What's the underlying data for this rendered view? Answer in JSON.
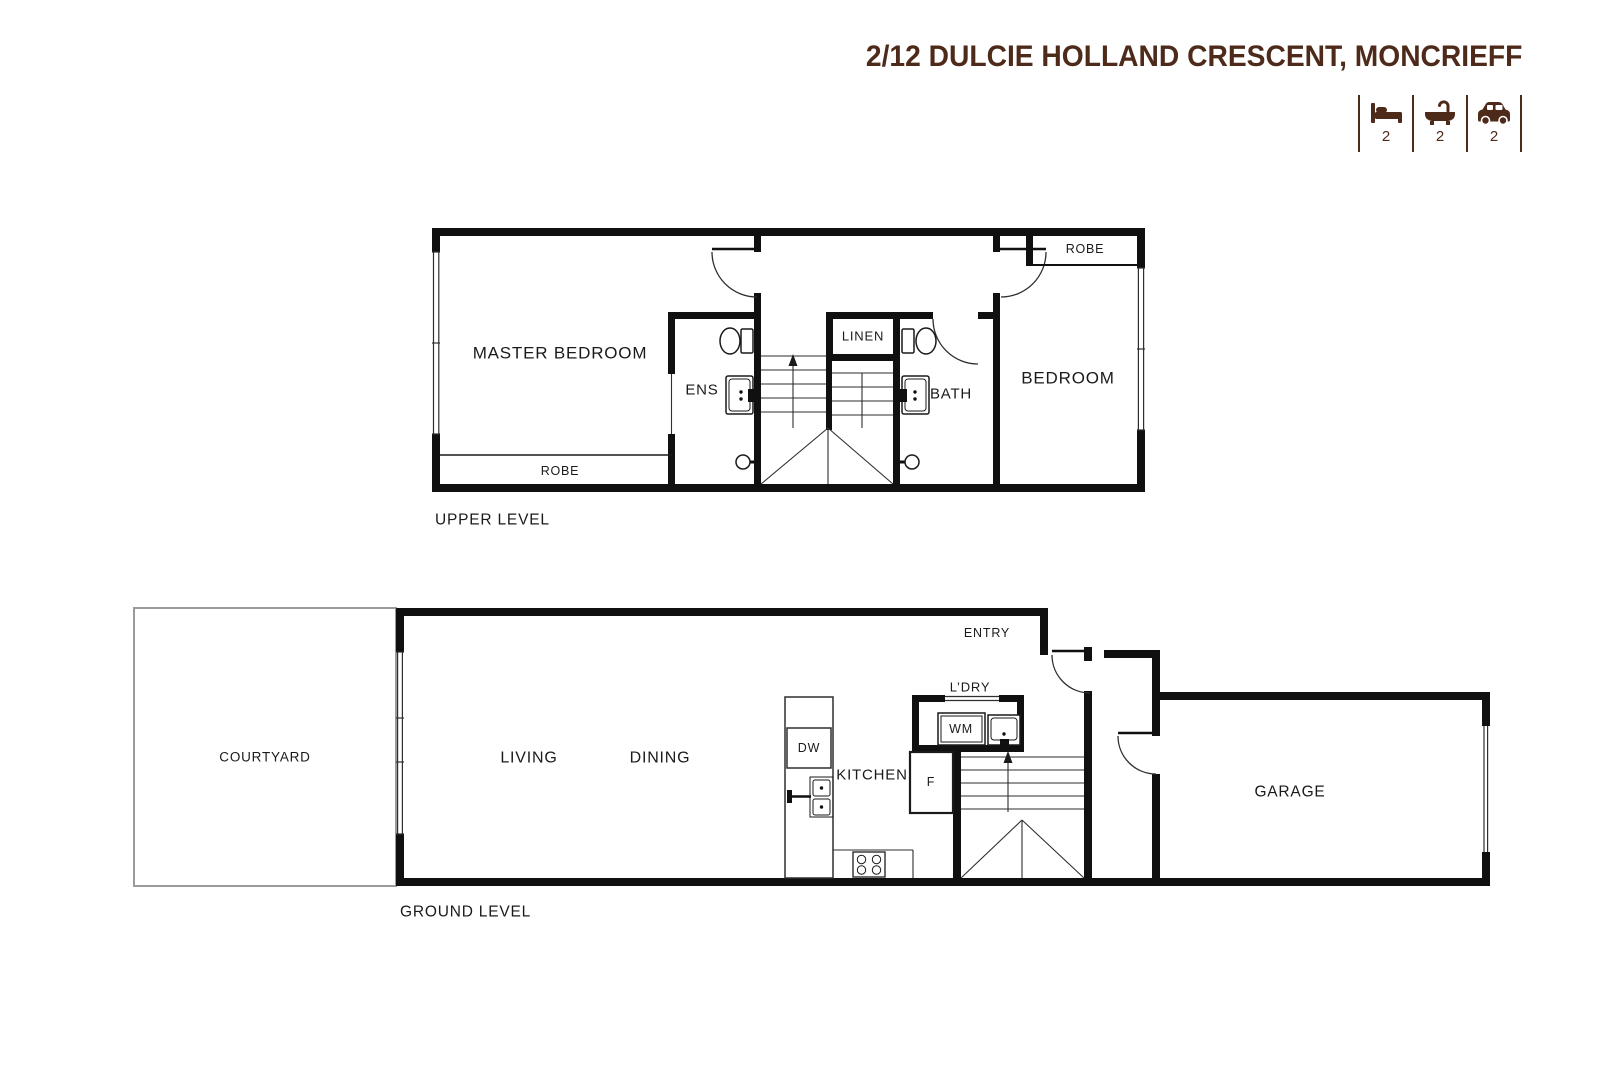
{
  "title": "2/12 DULCIE HOLLAND CRESCENT, MONCRIEFF",
  "colors": {
    "accent_brown": "#4e2a1a",
    "wall_black": "#101010",
    "courtyard_border": "#9b9b9b",
    "background": "#ffffff"
  },
  "stats": {
    "bedrooms": {
      "icon": "bed-icon",
      "value": "2"
    },
    "bathrooms": {
      "icon": "bath-icon",
      "value": "2"
    },
    "cars": {
      "icon": "car-icon",
      "value": "2"
    }
  },
  "upper_level": {
    "label": "UPPER LEVEL",
    "rooms": {
      "master_bedroom": "MASTER BEDROOM",
      "robe_master": "ROBE",
      "ens": "ENS",
      "linen": "LINEN",
      "bath": "BATH",
      "bedroom": "BEDROOM",
      "robe_bedroom": "ROBE"
    }
  },
  "ground_level": {
    "label": "GROUND LEVEL",
    "rooms": {
      "courtyard": "COURTYARD",
      "living": "LIVING",
      "dining": "DINING",
      "kitchen": "KITCHEN",
      "dishwasher": "DW",
      "fridge": "F",
      "laundry": "L’DRY",
      "washing_machine": "WM",
      "entry": "ENTRY",
      "garage": "GARAGE"
    }
  }
}
